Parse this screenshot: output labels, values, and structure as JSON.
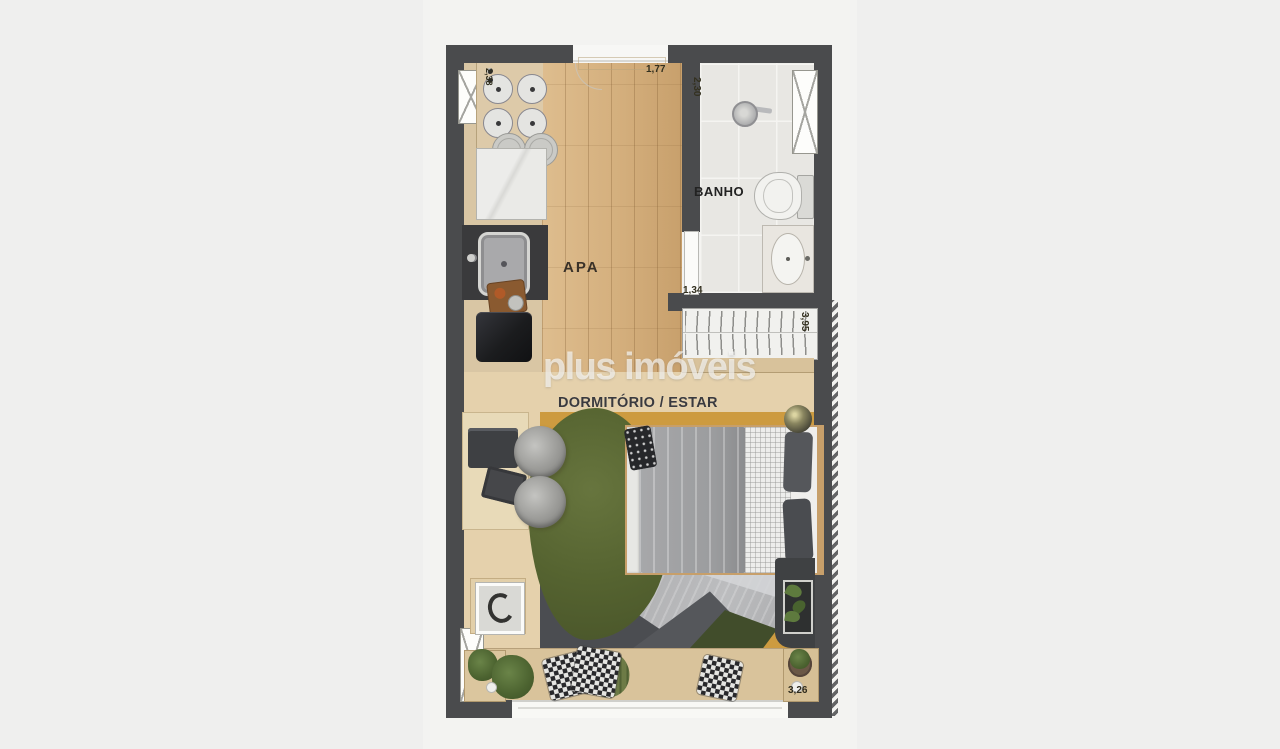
{
  "watermark": {
    "text": "plus imóveis"
  },
  "rooms": {
    "bathroom_label": "BANHO",
    "entry_label": "APA",
    "living_label": "DORMITÓRIO / ESTAR"
  },
  "dimensions": {
    "entry_width": "1,77",
    "bathroom_length": "2,30",
    "bathroom_door": "1,34",
    "wardrobe_wall": "3,95",
    "terrace_width": "3,26",
    "kitchen_wall": "2,38"
  },
  "colors": {
    "background": "#efefee",
    "plan_background": "#f3f3f1",
    "wall": "#4a4b4d",
    "wood_floor": "#d4af7d",
    "kitchen_counter": "#d9c6a4",
    "bath_tile": "#e8e7e3",
    "bedroom_floor": "#e5d1ac",
    "terrace_floor": "#d9c39b",
    "rug_green": "#556330",
    "rug_gray": "#b4b5b7",
    "rug_slate": "#4b4d51",
    "rug_mustard": "#cd9b40",
    "bed_duvet": "#9b9c9e",
    "bed_frame_wood": "#c79f6a"
  }
}
